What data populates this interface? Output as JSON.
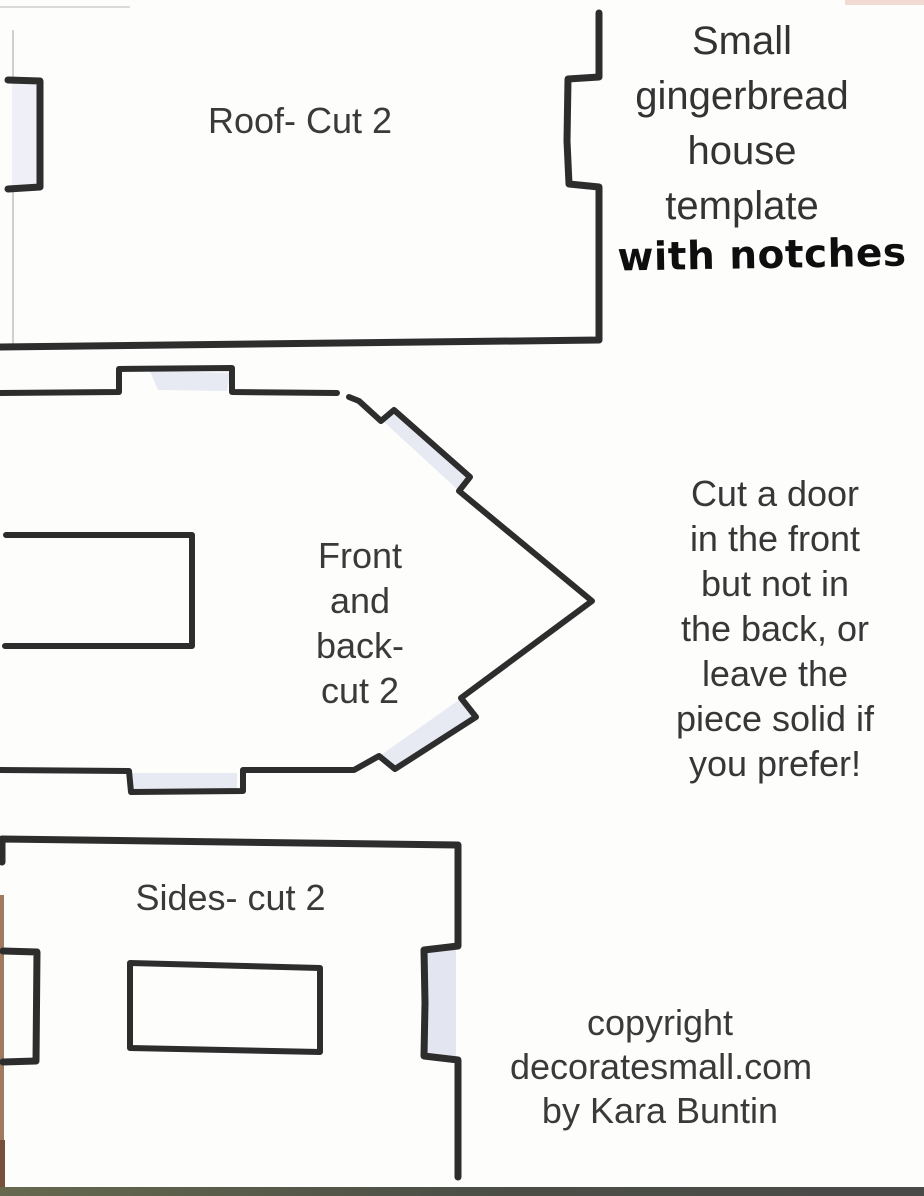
{
  "title": {
    "lines": [
      "Small",
      "gingerbread",
      "house",
      "template"
    ],
    "handwritten_note": "with notches"
  },
  "pieces": {
    "roof": {
      "label": "Roof- Cut 2"
    },
    "front_back": {
      "label_lines": [
        "Front",
        "and",
        "back-",
        "cut 2"
      ]
    },
    "sides": {
      "label": "Sides- cut 2"
    }
  },
  "instructions": {
    "lines": [
      "Cut a door",
      "in the front",
      "but not in",
      "the back, or",
      "leave the",
      "piece solid if",
      "you prefer!"
    ]
  },
  "copyright": {
    "lines": [
      "copyright",
      "decoratesmall.com",
      "by Kara Buntin"
    ]
  },
  "colors": {
    "line": "#2d2d2d",
    "notch_shading": "#e7e9f3",
    "scan_edge_brown": "#a07a5e",
    "scan_edge_bottom": "#55584a"
  }
}
